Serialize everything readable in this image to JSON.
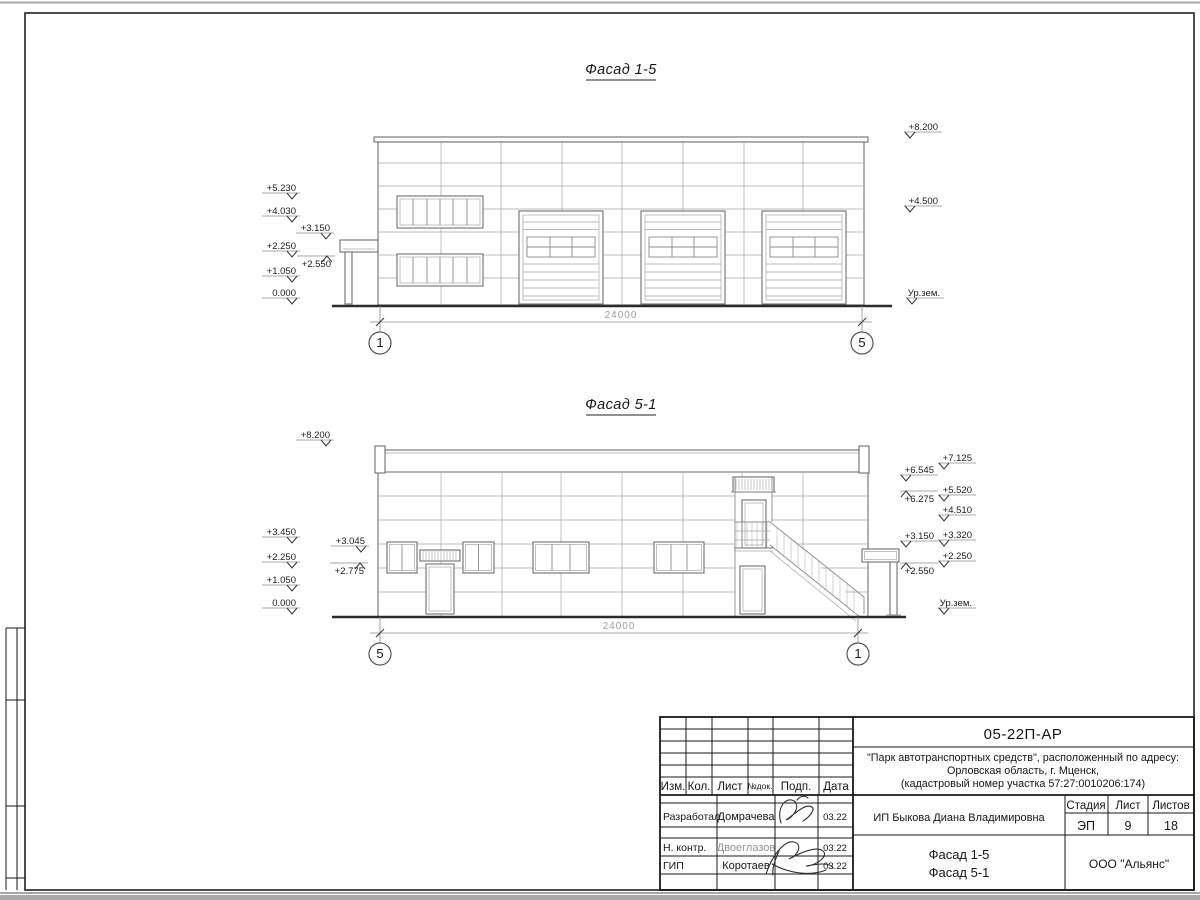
{
  "meta": {
    "sheet_bg": "#ffffff",
    "panel_line_color": "#a6a6a6",
    "ink_color": "#1a1a1a"
  },
  "facade_top": {
    "title": "Фасад 1-5",
    "dim_total": "24000",
    "axis_left": "1",
    "axis_right": "5",
    "marks_left": [
      "+5.230",
      "+4.030",
      "+3.150",
      "+2.250",
      "+2.550",
      "+1.050",
      "0.000"
    ],
    "marks_right": [
      "+8.200",
      "+4.500",
      "Ур.зем."
    ]
  },
  "facade_bottom": {
    "title": "Фасад 5-1",
    "dim_total": "24000",
    "axis_left": "5",
    "axis_right": "1",
    "marks_left": [
      "+8.200",
      "+3.450",
      "+3.045",
      "+2.250",
      "+2.775",
      "+1.050",
      "0.000"
    ],
    "marks_right_inner": [
      "+6.545",
      "+6.275",
      "+3.150",
      "+2.550"
    ],
    "marks_right_outer": [
      "+7.125",
      "+5.520",
      "+4.510",
      "+3.320",
      "+2.250",
      "Ур.зем."
    ]
  },
  "titleblock": {
    "doc_number": "05-22П-АР",
    "project_line1": "\"Парк автотранспортных средств\",  расположенный по адресу:",
    "project_line2": "Орловская область, г. Мценск,",
    "project_line3": "(кадастровый номер участка 57:27:0010206:174)",
    "col_izm": "Изм.",
    "col_kol": "Кол.",
    "col_list": "Лист",
    "col_ndok": "№док.",
    "col_podp": "Подп.",
    "col_data": "Дата",
    "row1_role": "Разработал",
    "row1_name": "Домрачева",
    "row1_date": "03.22",
    "row2_role": "Н. контр.",
    "row2_name": "Двоеглазов",
    "row2_date": "03.22",
    "row3_role": "ГИП",
    "row3_name": "Коротаев",
    "row3_date": "03.22",
    "client": "ИП Быкова Диана Владимировна",
    "stage_label": "Стадия",
    "sheet_label": "Лист",
    "sheets_label": "Листов",
    "stage": "ЭП",
    "sheet_no": "9",
    "sheets_total": "18",
    "drawing_name1": "Фасад 1-5",
    "drawing_name2": "Фасад 5-1",
    "organization": "ООО \"Альянс\""
  }
}
